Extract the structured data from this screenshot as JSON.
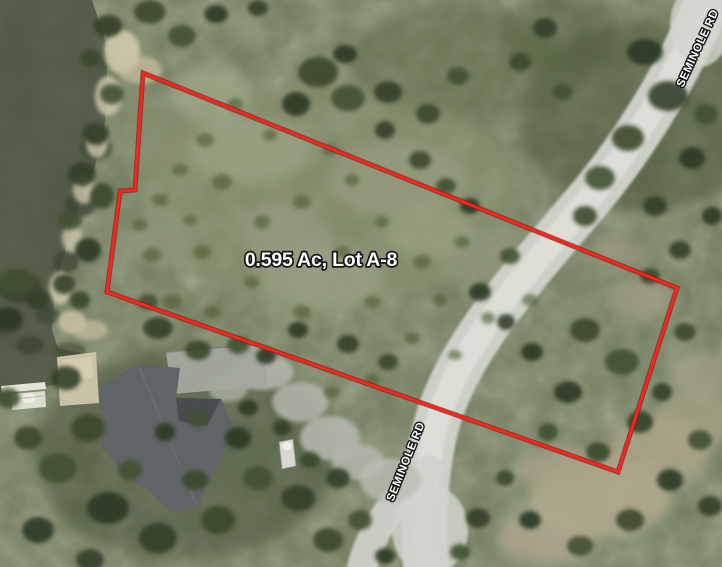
{
  "map": {
    "parcel": {
      "label": "0.595 Ac, Lot A-8",
      "boundary_points": "143,73 677,288 618,472 107,292 120,191 135,190",
      "boundary_color": "#ee2a1e"
    },
    "roads": {
      "main_label": "SEMINOLE RD",
      "top_label": "SEMINOLE RD"
    },
    "colors": {
      "label_text": "#ffffff",
      "label_outline": "#161616",
      "water": "#4e5643",
      "road_surface": "#d2d4cd",
      "house_roof": "#5c6264"
    }
  }
}
